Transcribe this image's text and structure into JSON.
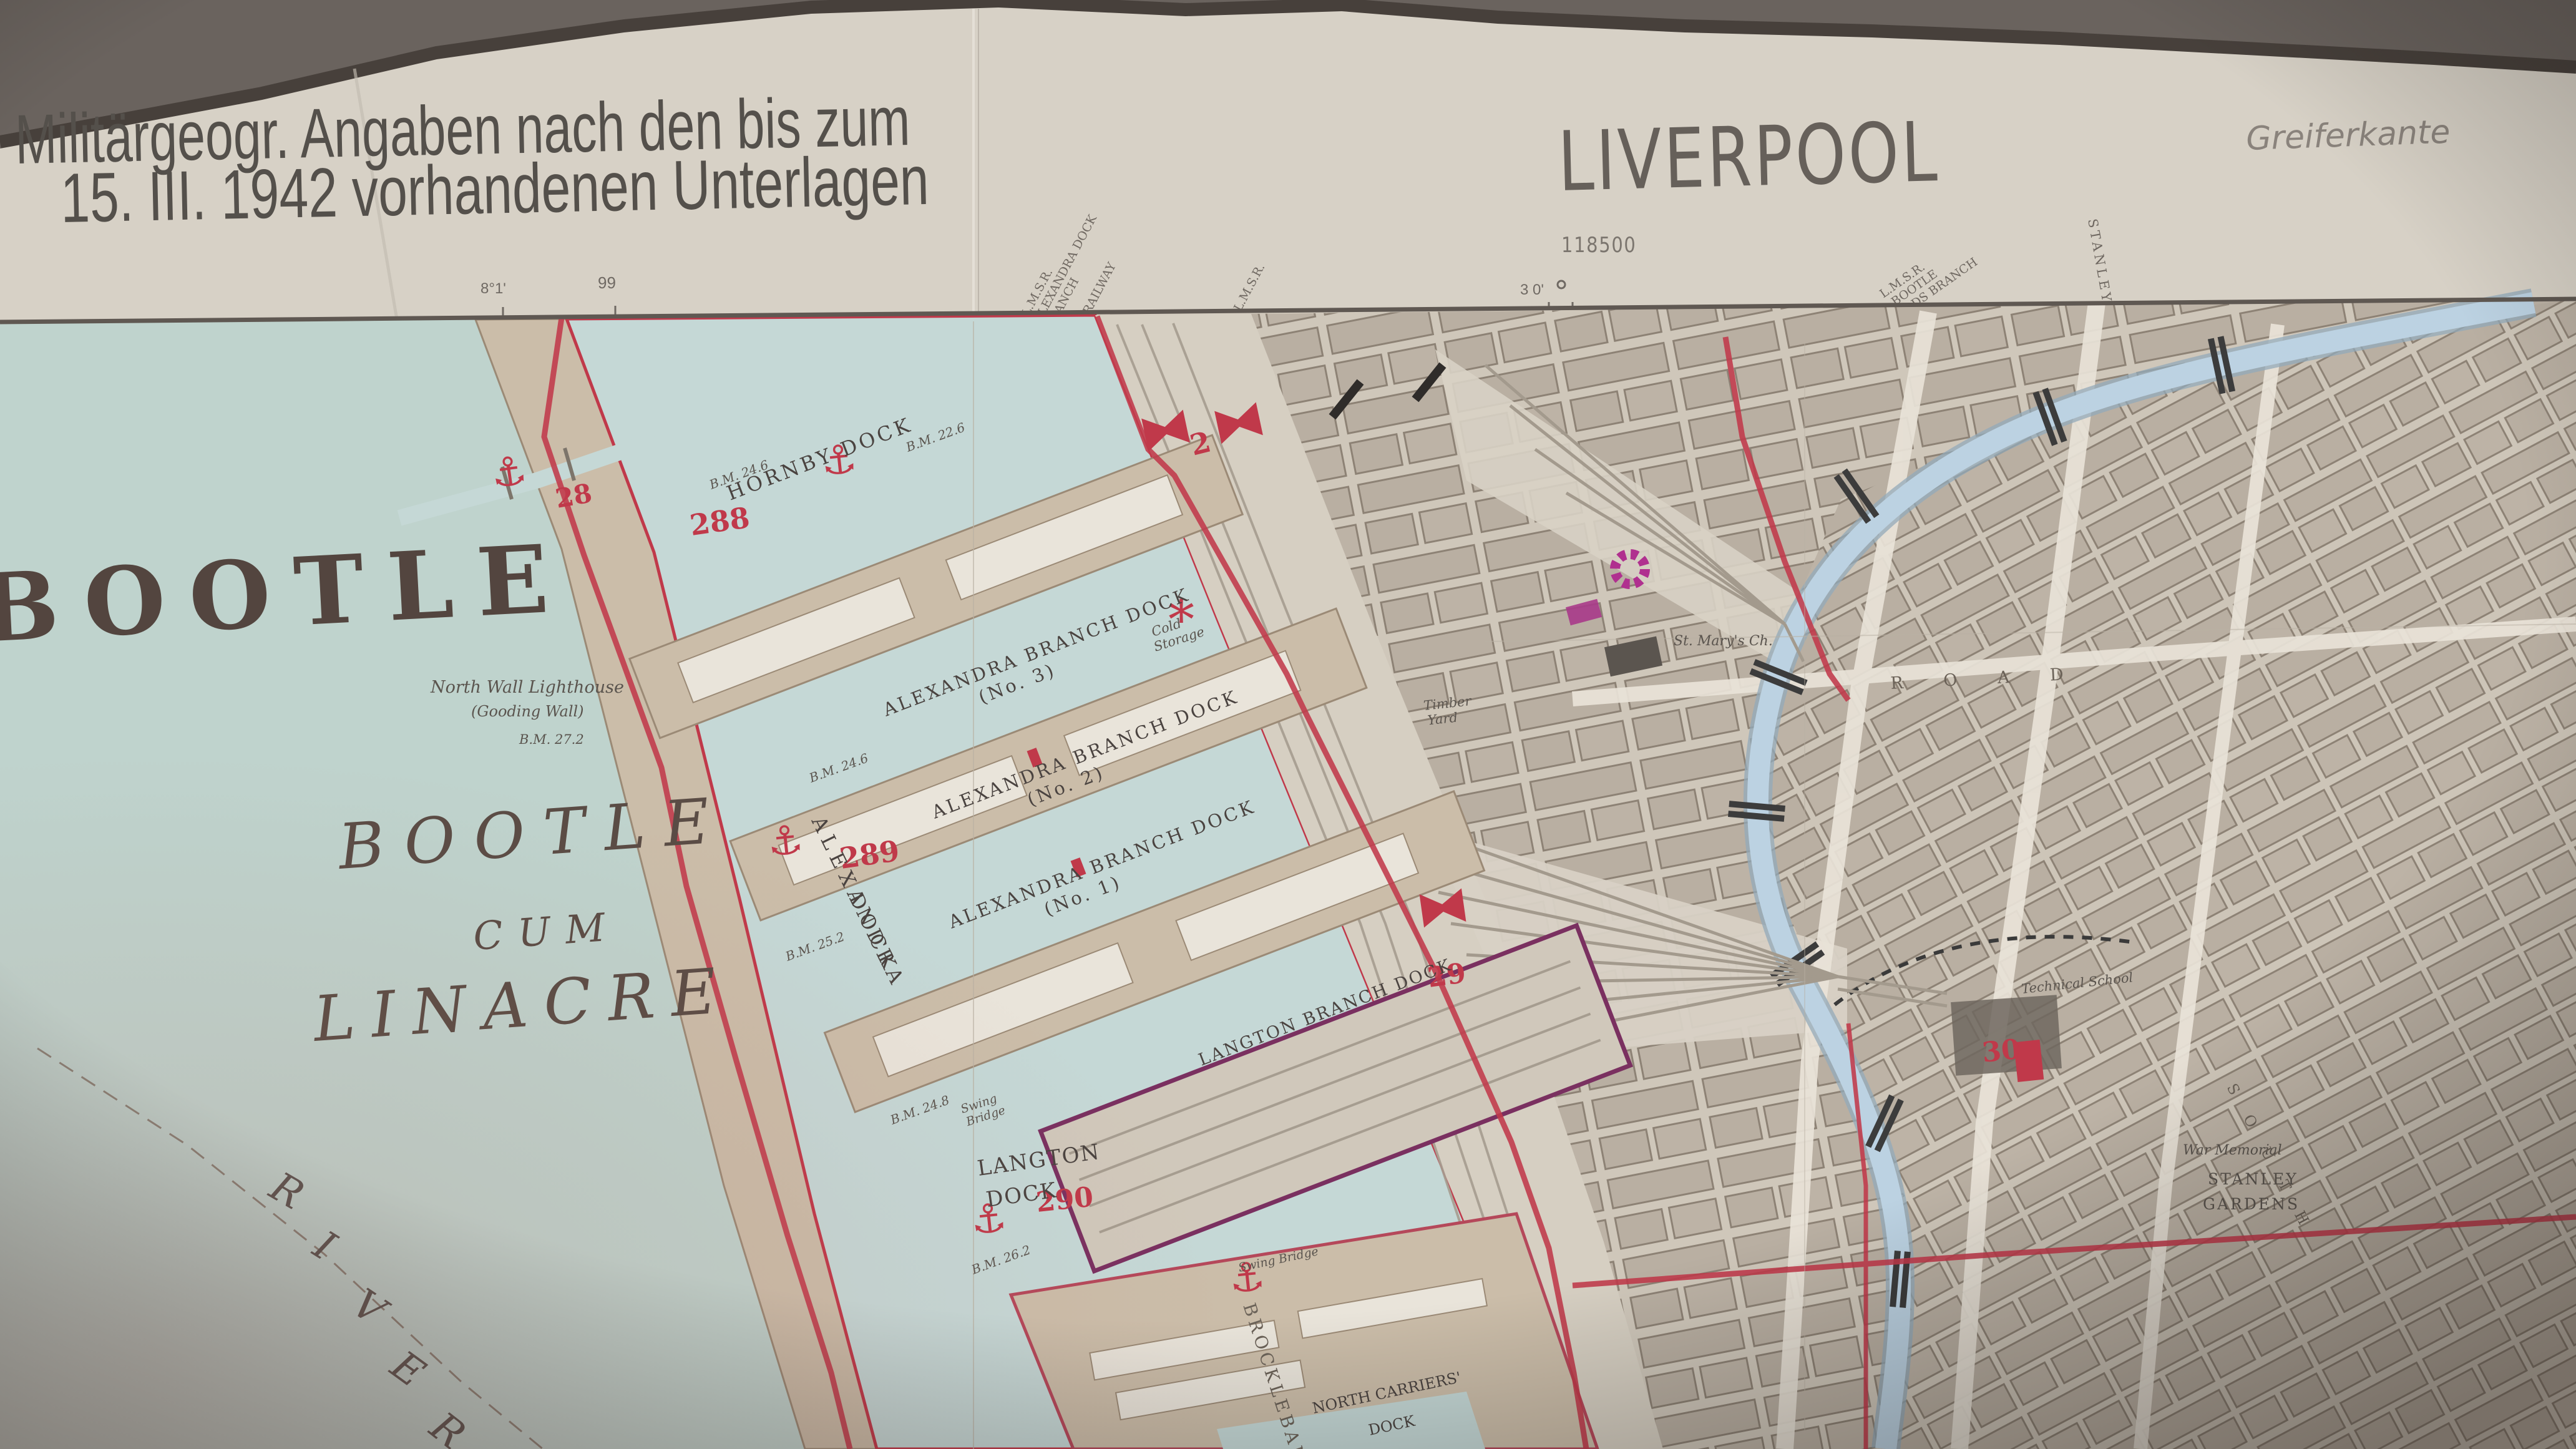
{
  "photo": {
    "backdrop_color": "#6a635e",
    "paper_color": "#d7d1c6"
  },
  "header": {
    "note_line1": "Militärgeogr. Angaben nach den bis zum",
    "note_line2": "15. III. 1942 vorhandenen Unterlagen",
    "title": "LIVERPOOL",
    "handwritten_annotation": "Greiferkante",
    "sheet_number": "118500",
    "tick_left_degrees": "8°1'",
    "tick_left_grid": "99",
    "tick_right_degrees": "3 0'"
  },
  "margin_railway_labels": {
    "l1a": "L.M.S.R.",
    "l1b": "ALEXANDRA DOCK",
    "l1c": "BRANCH",
    "l2": "RAILWAY",
    "l3": "L.M.S.R.",
    "bootle_goods_a": "L.M.S.R.",
    "bootle_goods_b": "BOOTLE",
    "bootle_goods_c": "GOODS BRANCH",
    "stanley_road": "STANLEY"
  },
  "place_names": {
    "bootle": "BOOTLE",
    "parish_line1": "BOOTLE",
    "parish_line2": "CUM",
    "parish_line3": "LINACRE",
    "river_l1": "R",
    "river_l2": "I",
    "river_l3": "V",
    "river_l4": "E",
    "river_l5": "R"
  },
  "docks": {
    "hornby": "HORNBY DOCK",
    "alexandra_branch": "ALEXANDRA BRANCH DOCK",
    "no3": "(No. 3)",
    "no2": "(No. 2)",
    "no1": "(No. 1)",
    "alexandra_a": "ALEXANDRA",
    "alexandra_b": "DOCK",
    "langton_branch": "LANGTON BRANCH DOCK",
    "langton_a": "LANGTON",
    "langton_b": "DOCK",
    "north_carriers_a": "NORTH CARRIERS'",
    "north_carriers_b": "DOCK",
    "brocklebank": "BROCKLEBANK"
  },
  "red_index_numbers": {
    "n28": "28",
    "n2": "2",
    "n288": "288",
    "n289": "289",
    "n29": "29",
    "n290": "290",
    "n30": "30"
  },
  "small_labels": {
    "lighthouse_line1": "North Wall Lighthouse",
    "lighthouse_line2": "(Gooding Wall)",
    "bm_27_2": "B.M. 27.2",
    "bm_22_6": "B.M. 22.6",
    "bm_24_6": "B.M. 24.6",
    "bm_25_2": "B.M. 25.2",
    "bm_24_8": "B.M. 24.8",
    "bm_26_2": "B.M. 26.2",
    "swing_a": "Swing",
    "swing_b": "Bridge",
    "swing_bridge": "Swing Bridge",
    "cold_a": "Cold",
    "cold_b": "Storage",
    "timber_a": "Timber",
    "timber_b": "Yard",
    "st_marys": "St. Mary's Ch.",
    "war_memorial": "War Memorial",
    "stanley_gardens_a": "STANLEY",
    "stanley_gardens_b": "GARDENS",
    "technical_school": "Technical School",
    "road": "R O A D",
    "south": "S O U T H"
  },
  "symbols": {
    "anchor": "⚓",
    "star": "*"
  },
  "map_colors": {
    "boundary_red": "#c0394a",
    "industry_magenta": "#b0308f",
    "river_water": "#bfd3cd",
    "dock_water": "#c5d8d6",
    "canal_water": "#bcd2e2",
    "quay_tan": "#cbbda9",
    "urban_block": "#b9afa2"
  }
}
